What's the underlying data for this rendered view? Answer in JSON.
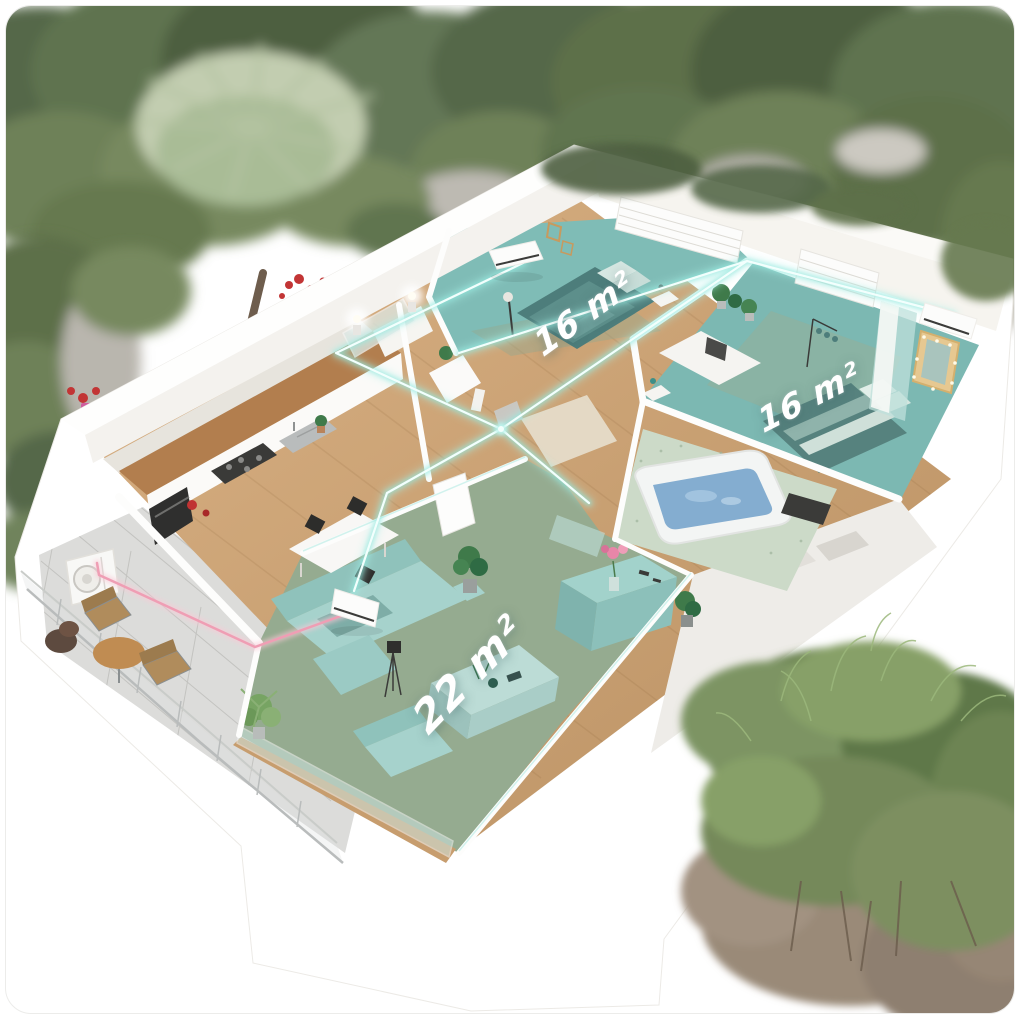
{
  "rooms": [
    {
      "name": "bedroom-top",
      "area_label": "16 m²"
    },
    {
      "name": "bedroom-right",
      "area_label": "16 m²"
    },
    {
      "name": "living-room",
      "area_label": "22 m²"
    }
  ],
  "palette": {
    "wall_white": "#fbfaf8",
    "wood_floor": "#c89e6f",
    "highlight_teal": "#7fbcb6",
    "highlight_green": "#95ab90",
    "pipe_cyan": "#9feee6",
    "pipe_pink": "#f0a2b8",
    "foliage_green": "#5d7049",
    "water_blue": "#85aed0",
    "furniture_teal": "#a6d2cc"
  }
}
